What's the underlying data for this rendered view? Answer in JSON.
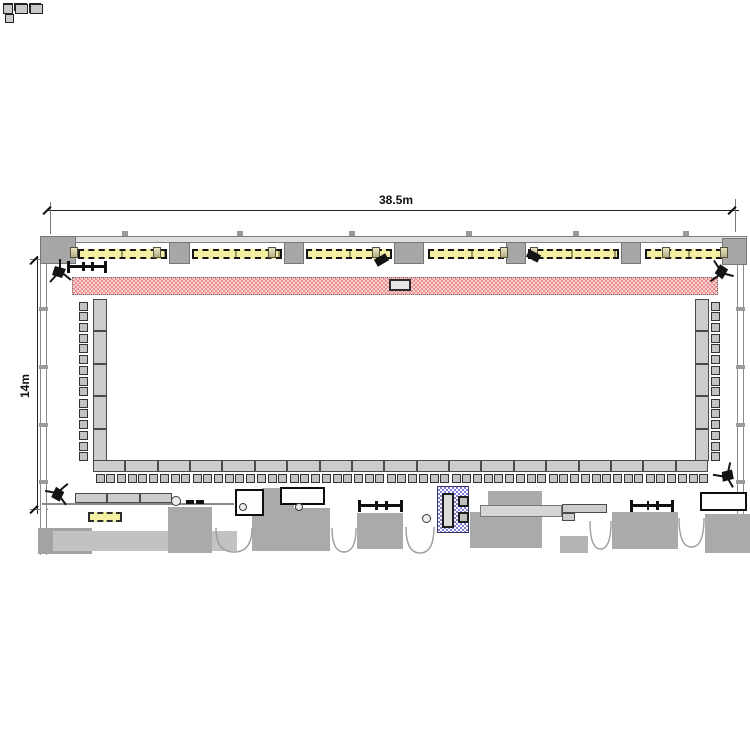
{
  "page": {
    "background": "#ffffff",
    "type": "floor-plan-drawing"
  },
  "plan": {
    "room": {
      "width_label": "38.5m",
      "height_label": "14m"
    },
    "furniture_counts": {
      "left_desk_segments": 5,
      "right_desk_segments": 5,
      "bottom_desk_segments": 19,
      "chairs_per_segment": 3,
      "service_table_segments": 3,
      "window_strip_count": 6,
      "wall_column_pier_count": 7,
      "window_sill_icon_count": 8,
      "speaker_tripod_count": 4,
      "wall_speaker_count": 2,
      "door_opening_count": 5,
      "service_counter_count": 3,
      "equipment_rack_count": 3
    },
    "zones": {
      "stage_strip": "hatched strip along top wall",
      "lectern_on_stage": "small box at stage center",
      "blue_hatched_unit": "technical unit near bottom center"
    }
  },
  "colors": {
    "stage_pink": "#ea9090",
    "stage_pink_light": "#f7cfcf",
    "window_yellow": "#f4efa3",
    "blue_unit": "#7f7fd6",
    "furniture_gray": "#cccccc",
    "wall_gray": "#a7a7a7",
    "mass_gray": "#aaaaaa",
    "dimension_text": "#111111"
  }
}
